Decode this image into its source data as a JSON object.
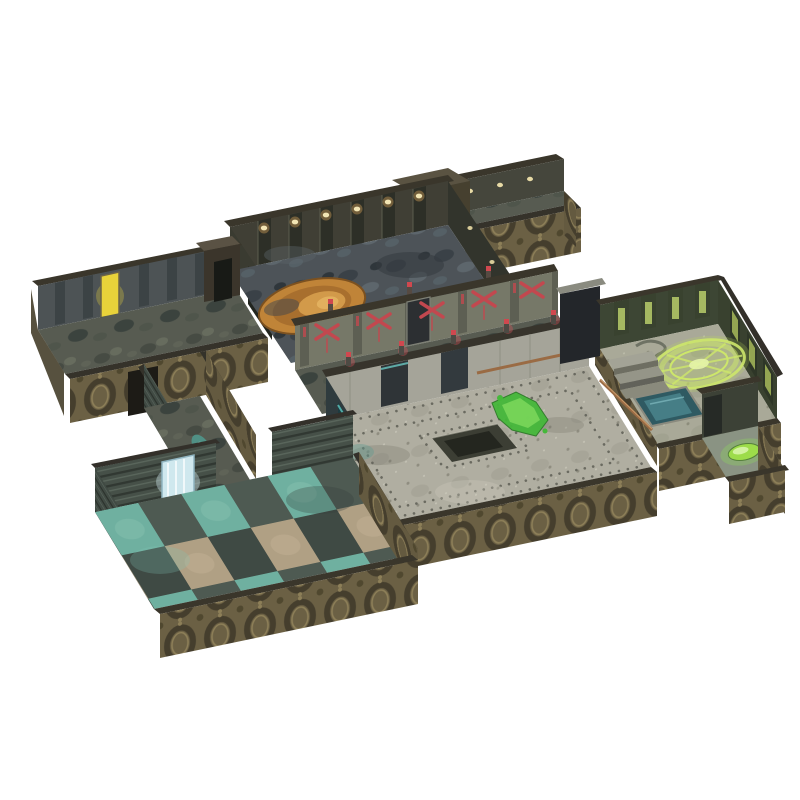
{
  "image": {
    "kind": "product-photo",
    "subject": "Modular sci-fi dungeon tabletop terrain set, isometric view, photographed on a plain white background",
    "background": "#ffffff"
  },
  "colors": {
    "wall_bronze": "#6b6044",
    "wall_bronze_dark": "#453e2d",
    "wall_bronze_light": "#8d7f58",
    "wall_top_strip": "#3a362b",
    "wall_interior_dark": "#3f4038",
    "hall_wall_grey": "#a5a499",
    "teal_wall": "#2f3b3e",
    "floor_stone": "#b0aea1",
    "floor_grime": "#575b51",
    "room_a_floor": "#4d5358",
    "mural_orange": "#c08438",
    "mural_orange_light": "#e2b05e",
    "conduit_red": "#c2484f",
    "red_tip": "#d0484f",
    "slime_green": "#45b83a",
    "slime_green_light": "#7fd95e",
    "rune_green": "#cde76a",
    "pool_teal": "#467e86",
    "puddle_teal": "#4f9a8e",
    "checker_teal": "#6fb0a0",
    "checker_tan": "#b0a084",
    "checker_slate": "#4e5a52",
    "checker_dark": "#3f4a44",
    "door_yellow": "#e8d23a",
    "capsule_green": "#9ddc4a",
    "waterfall_blue": "#cfe8ee",
    "light_warm": "#f2e5b4",
    "pipe_copper": "#9a6b44"
  },
  "regions": [
    {
      "name": "upper-corridor",
      "description": "Short corridor arm at top with ornate bronze outer wall and end cap"
    },
    {
      "name": "mural-room",
      "description": "Large room with dark grimy floor, orange circular painted mural, panelled walls with warm lights"
    },
    {
      "name": "left-wing-corridor",
      "description": "Long western corridor with glowing yellow door slit and arched doorway"
    },
    {
      "name": "red-conduit-corridor",
      "description": "Corridor walls carrying glowing red X-shaped conduits and red-tipped pillars"
    },
    {
      "name": "central-hall",
      "description": "Large grey riveted stone floor with central dark pit and bright green slime trail"
    },
    {
      "name": "rune-room",
      "description": "Eastern room with glowing green summoning circle, descending steps and teal pool"
    },
    {
      "name": "side-alcove",
      "description": "Small south-east alcove holding a glowing green capsule"
    },
    {
      "name": "stair-corridor",
      "description": "Diagonal connecting corridor with teal ooze puddle"
    },
    {
      "name": "checkered-room",
      "description": "South-west room with teal and tan checkerboard tiles and a luminous water doorway"
    }
  ],
  "counts": {
    "rooms": 4,
    "corridors": 4,
    "alcoves": 1
  }
}
